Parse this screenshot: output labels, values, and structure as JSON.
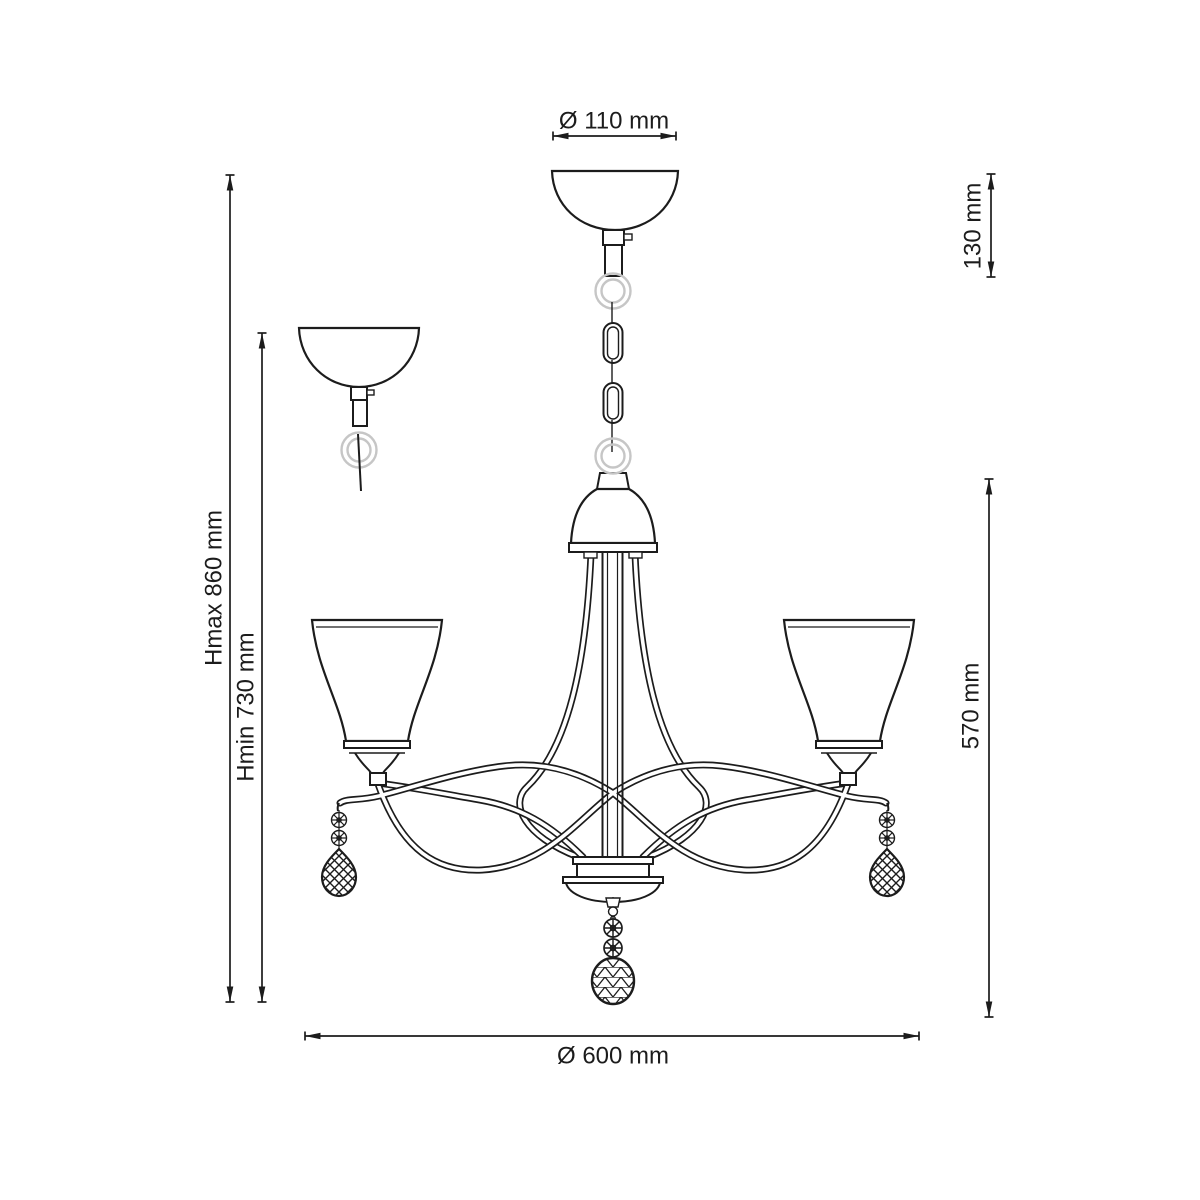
{
  "meta": {
    "title": "Chandelier technical line drawing, front view with ceiling-canopy detail"
  },
  "colors": {
    "background": "#ffffff",
    "line": "#1c1c1c",
    "light_metal_ring": "#c6c6c6"
  },
  "dimensions": {
    "canopy_diameter": "Ø 110 mm",
    "canopy_assembly_height": "130 mm",
    "max_height": "Hmax 860 mm",
    "min_height": "Hmin 730 mm",
    "fixture_height": "570 mm",
    "fixture_diameter": "Ø 600 mm"
  }
}
